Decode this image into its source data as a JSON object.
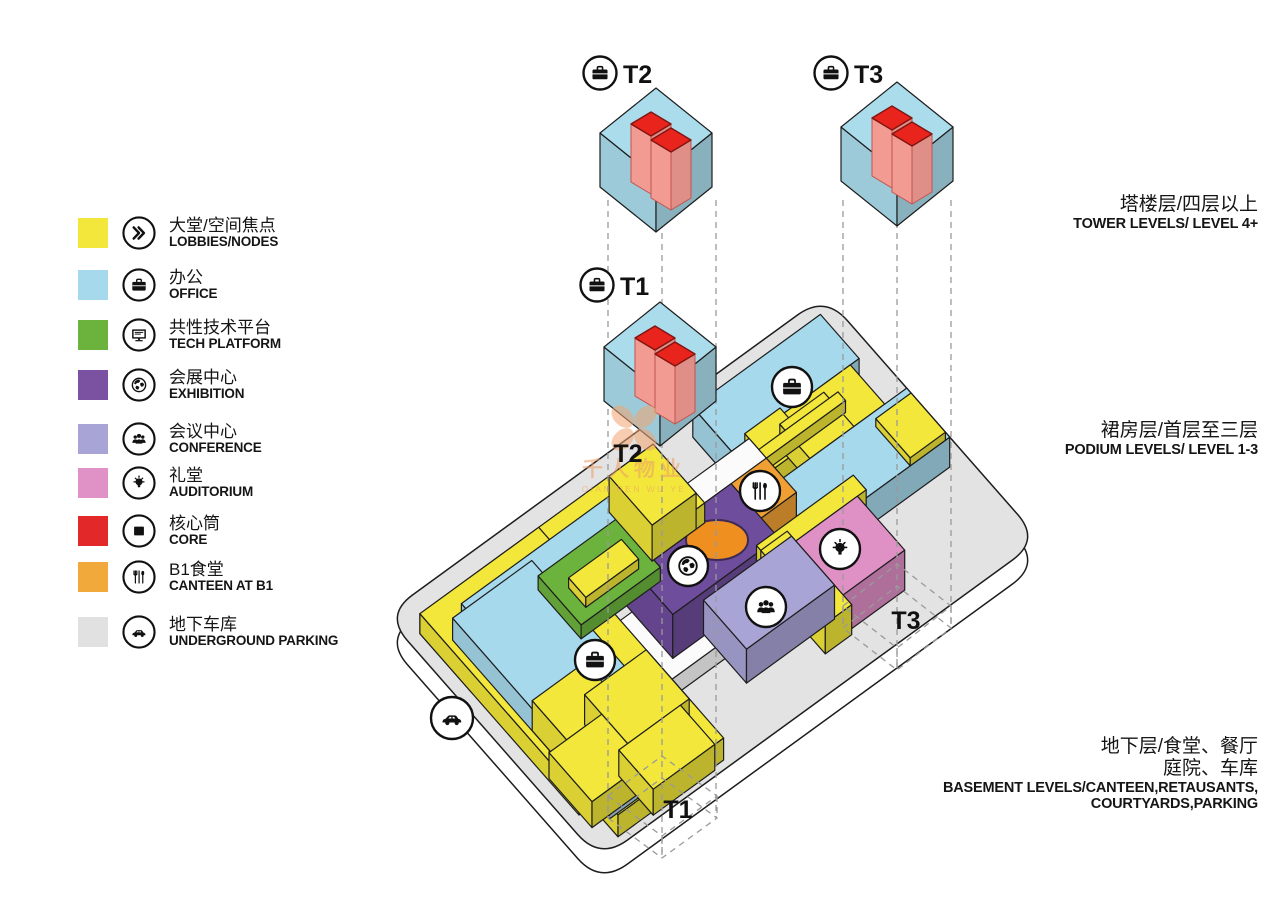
{
  "legend": {
    "items": [
      {
        "zh": "大堂/空间焦点",
        "en": "LOBBIES/NODES",
        "color": "#f2e73a",
        "icon": "chevrons"
      },
      {
        "zh": "办公",
        "en": "OFFICE",
        "color": "#a6d9eb",
        "icon": "briefcase"
      },
      {
        "zh": "共性技术平台",
        "en": "TECH PLATFORM",
        "color": "#6cb33e",
        "icon": "monitor"
      },
      {
        "zh": "会展中心",
        "en": "EXHIBITION",
        "color": "#7a52a1",
        "icon": "globe"
      },
      {
        "zh": "会议中心",
        "en": "CONFERENCE",
        "color": "#a9a4d6",
        "icon": "people"
      },
      {
        "zh": "礼堂",
        "en": "AUDITORIUM",
        "color": "#e092c6",
        "icon": "bulb"
      },
      {
        "zh": "核心筒",
        "en": "CORE",
        "color": "#e3282a",
        "icon": "core"
      },
      {
        "zh": "B1食堂",
        "en": "CANTEEN AT B1",
        "color": "#f2a93c",
        "icon": "utensils"
      },
      {
        "zh": "地下车库",
        "en": "UNDERGROUND PARKING",
        "color": "#e1e1e1",
        "icon": "car"
      }
    ]
  },
  "levels": [
    {
      "zh": "塔楼层/四层以上",
      "en": "TOWER LEVELS/ LEVEL 4+"
    },
    {
      "zh": "裙房层/首层至三层",
      "en": "PODIUM LEVELS/ LEVEL 1-3"
    },
    {
      "zh1": "地下层/食堂、餐厅",
      "zh2": "庭院、车库",
      "en1": "BASEMENT LEVELS/CANTEEN,RETAUSANTS,",
      "en2": "COURTYARDS,PARKING"
    }
  ],
  "towers": {
    "t1": "T1",
    "t2": "T2",
    "t3": "T3"
  },
  "watermark": {
    "zh": "千人物业",
    "latin": "QIAN REN WU YE"
  },
  "colors": {
    "yellow": "#f2e73a",
    "blue": "#a6d9eb",
    "green": "#6cb33e",
    "purple": "#6f4d9d",
    "lavender": "#a9a4d6",
    "pink": "#df90c5",
    "red": "#e8241c",
    "salmon": "#f29b93",
    "orange": "#f0a033",
    "hole_orange": "#ee8f20",
    "slab": "#e3e3e3",
    "slab_side": "#ffffff",
    "tower_blue": "#aadcec",
    "outline": "#1d1d1d",
    "dash": "#9a9a9a",
    "frame": "#fbfbfb",
    "watermark_orange": "#f2a470"
  }
}
